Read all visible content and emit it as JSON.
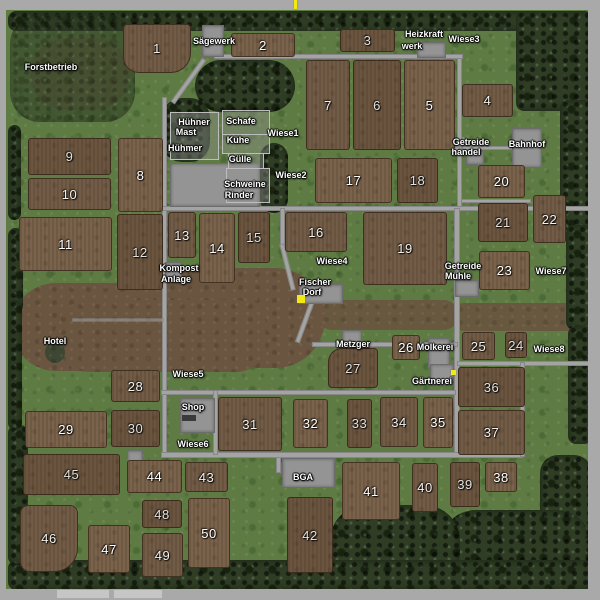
{
  "map": {
    "colors": {
      "grass": "#5e7b44",
      "field": "#6d5741",
      "forest": "#2e3d24",
      "dirt": "#6a5540",
      "road": "#a4a4a4",
      "building": "#949494",
      "frame": "#a9a9a9",
      "marker_yellow": "#f2ea12",
      "label_text": "#ffffff"
    },
    "fields": [
      {
        "n": "1",
        "x": 123,
        "y": 24,
        "w": 68,
        "h": 49,
        "br": "4px 4px 20px 16px"
      },
      {
        "n": "2",
        "x": 231,
        "y": 33,
        "w": 64,
        "h": 24
      },
      {
        "n": "3",
        "x": 340,
        "y": 29,
        "w": 55,
        "h": 23
      },
      {
        "n": "4",
        "x": 462,
        "y": 84,
        "w": 51,
        "h": 33
      },
      {
        "n": "5",
        "x": 404,
        "y": 60,
        "w": 51,
        "h": 90
      },
      {
        "n": "6",
        "x": 353,
        "y": 60,
        "w": 48,
        "h": 90
      },
      {
        "n": "7",
        "x": 306,
        "y": 60,
        "w": 44,
        "h": 90
      },
      {
        "n": "8",
        "x": 118,
        "y": 138,
        "w": 45,
        "h": 74
      },
      {
        "n": "9",
        "x": 28,
        "y": 138,
        "w": 83,
        "h": 37
      },
      {
        "n": "10",
        "x": 28,
        "y": 178,
        "w": 83,
        "h": 32
      },
      {
        "n": "11",
        "x": 19,
        "y": 217,
        "w": 93,
        "h": 54
      },
      {
        "n": "12",
        "x": 117,
        "y": 214,
        "w": 46,
        "h": 76
      },
      {
        "n": "13",
        "x": 168,
        "y": 212,
        "w": 28,
        "h": 46
      },
      {
        "n": "14",
        "x": 199,
        "y": 213,
        "w": 36,
        "h": 70
      },
      {
        "n": "15",
        "x": 238,
        "y": 212,
        "w": 32,
        "h": 51
      },
      {
        "n": "16",
        "x": 285,
        "y": 212,
        "w": 62,
        "h": 40
      },
      {
        "n": "17",
        "x": 315,
        "y": 158,
        "w": 77,
        "h": 45
      },
      {
        "n": "18",
        "x": 397,
        "y": 158,
        "w": 41,
        "h": 45
      },
      {
        "n": "19",
        "x": 363,
        "y": 212,
        "w": 84,
        "h": 73
      },
      {
        "n": "20",
        "x": 478,
        "y": 165,
        "w": 47,
        "h": 33
      },
      {
        "n": "21",
        "x": 478,
        "y": 203,
        "w": 50,
        "h": 39
      },
      {
        "n": "22",
        "x": 533,
        "y": 195,
        "w": 33,
        "h": 48
      },
      {
        "n": "23",
        "x": 479,
        "y": 251,
        "w": 51,
        "h": 39
      },
      {
        "n": "24",
        "x": 505,
        "y": 332,
        "w": 22,
        "h": 26
      },
      {
        "n": "25",
        "x": 462,
        "y": 332,
        "w": 33,
        "h": 28
      },
      {
        "n": "26",
        "x": 392,
        "y": 335,
        "w": 28,
        "h": 25
      },
      {
        "n": "27",
        "x": 328,
        "y": 348,
        "w": 50,
        "h": 40,
        "br": "14px 4px 4px 4px"
      },
      {
        "n": "28",
        "x": 111,
        "y": 370,
        "w": 49,
        "h": 32
      },
      {
        "n": "29",
        "x": 25,
        "y": 411,
        "w": 82,
        "h": 37
      },
      {
        "n": "30",
        "x": 111,
        "y": 410,
        "w": 49,
        "h": 37
      },
      {
        "n": "31",
        "x": 218,
        "y": 397,
        "w": 64,
        "h": 54
      },
      {
        "n": "32",
        "x": 293,
        "y": 399,
        "w": 35,
        "h": 49
      },
      {
        "n": "33",
        "x": 347,
        "y": 399,
        "w": 25,
        "h": 49
      },
      {
        "n": "34",
        "x": 380,
        "y": 397,
        "w": 38,
        "h": 50
      },
      {
        "n": "35",
        "x": 423,
        "y": 397,
        "w": 30,
        "h": 51
      },
      {
        "n": "36",
        "x": 458,
        "y": 367,
        "w": 67,
        "h": 40
      },
      {
        "n": "37",
        "x": 458,
        "y": 410,
        "w": 67,
        "h": 45
      },
      {
        "n": "38",
        "x": 485,
        "y": 462,
        "w": 32,
        "h": 30
      },
      {
        "n": "39",
        "x": 450,
        "y": 462,
        "w": 30,
        "h": 45
      },
      {
        "n": "40",
        "x": 412,
        "y": 463,
        "w": 26,
        "h": 49
      },
      {
        "n": "41",
        "x": 342,
        "y": 462,
        "w": 58,
        "h": 58
      },
      {
        "n": "42",
        "x": 287,
        "y": 497,
        "w": 46,
        "h": 76
      },
      {
        "n": "43",
        "x": 185,
        "y": 462,
        "w": 43,
        "h": 30
      },
      {
        "n": "44",
        "x": 127,
        "y": 460,
        "w": 55,
        "h": 33
      },
      {
        "n": "45",
        "x": 23,
        "y": 454,
        "w": 97,
        "h": 41
      },
      {
        "n": "46",
        "x": 20,
        "y": 505,
        "w": 58,
        "h": 67,
        "br": "8px 8px 24px 10px"
      },
      {
        "n": "47",
        "x": 88,
        "y": 525,
        "w": 42,
        "h": 48
      },
      {
        "n": "48",
        "x": 142,
        "y": 500,
        "w": 40,
        "h": 28
      },
      {
        "n": "49",
        "x": 142,
        "y": 533,
        "w": 41,
        "h": 44
      },
      {
        "n": "50",
        "x": 188,
        "y": 498,
        "w": 42,
        "h": 70
      }
    ],
    "place_labels": [
      {
        "t": "Forstbetrieb",
        "x": 51,
        "y": 67
      },
      {
        "t": "Sägewerk",
        "x": 214,
        "y": 41
      },
      {
        "t": "Heizkraft",
        "x": 424,
        "y": 34
      },
      {
        "t": "werk",
        "x": 412,
        "y": 46
      },
      {
        "t": "Wiese3",
        "x": 464,
        "y": 39
      },
      {
        "t": "Hühner",
        "x": 194,
        "y": 122
      },
      {
        "t": "Mast",
        "x": 186,
        "y": 132
      },
      {
        "t": "Hühmer",
        "x": 185,
        "y": 148
      },
      {
        "t": "Schafe",
        "x": 241,
        "y": 121
      },
      {
        "t": "Kühe",
        "x": 238,
        "y": 140
      },
      {
        "t": "Gülle",
        "x": 240,
        "y": 159
      },
      {
        "t": "Schweine",
        "x": 245,
        "y": 184
      },
      {
        "t": "Rinder",
        "x": 239,
        "y": 195
      },
      {
        "t": "Wiese1",
        "x": 283,
        "y": 133
      },
      {
        "t": "Wiese2",
        "x": 291,
        "y": 175
      },
      {
        "t": "Getreide",
        "x": 471,
        "y": 142
      },
      {
        "t": "handel",
        "x": 466,
        "y": 152
      },
      {
        "t": "Bahnhof",
        "x": 527,
        "y": 144
      },
      {
        "t": "Getreide",
        "x": 463,
        "y": 266
      },
      {
        "t": "Mühle",
        "x": 458,
        "y": 276
      },
      {
        "t": "Wiese7",
        "x": 551,
        "y": 271
      },
      {
        "t": "Kompost",
        "x": 179,
        "y": 268
      },
      {
        "t": "Anlage",
        "x": 176,
        "y": 279
      },
      {
        "t": "Wiese4",
        "x": 332,
        "y": 261
      },
      {
        "t": "Fischer",
        "x": 315,
        "y": 282
      },
      {
        "t": "Dorf",
        "x": 312,
        "y": 292
      },
      {
        "t": "Hotel",
        "x": 55,
        "y": 341
      },
      {
        "t": "Wiese5",
        "x": 188,
        "y": 374
      },
      {
        "t": "Metzger",
        "x": 353,
        "y": 344
      },
      {
        "t": "Molkerei",
        "x": 435,
        "y": 347
      },
      {
        "t": "Gärtnerei",
        "x": 432,
        "y": 381
      },
      {
        "t": "Wiese8",
        "x": 549,
        "y": 349
      },
      {
        "t": "Shop",
        "x": 193,
        "y": 407
      },
      {
        "t": "Wiese6",
        "x": 193,
        "y": 444
      },
      {
        "t": "BGA",
        "x": 303,
        "y": 477
      }
    ],
    "roads": [
      {
        "x": 214,
        "y": 54,
        "w": 249,
        "h": 5
      },
      {
        "x": 186,
        "y": 54,
        "w": 5,
        "h": 54,
        "rot": 36
      },
      {
        "x": 162,
        "y": 97,
        "w": 5,
        "h": 360
      },
      {
        "x": 457,
        "y": 58,
        "w": 5,
        "h": 150
      },
      {
        "x": 161,
        "y": 206,
        "w": 442,
        "h": 5
      },
      {
        "x": 454,
        "y": 208,
        "w": 6,
        "h": 250
      },
      {
        "x": 457,
        "y": 361,
        "w": 146,
        "h": 5
      },
      {
        "x": 312,
        "y": 342,
        "w": 146,
        "h": 5
      },
      {
        "x": 303,
        "y": 296,
        "w": 5,
        "h": 48,
        "rot": 20
      },
      {
        "x": 280,
        "y": 208,
        "w": 5,
        "h": 38
      },
      {
        "x": 285,
        "y": 243,
        "w": 5,
        "h": 48,
        "rot": -14
      },
      {
        "x": 161,
        "y": 452,
        "w": 362,
        "h": 6
      },
      {
        "x": 161,
        "y": 390,
        "w": 295,
        "h": 5
      },
      {
        "x": 213,
        "y": 390,
        "w": 5,
        "h": 65
      },
      {
        "x": 520,
        "y": 362,
        "w": 5,
        "h": 95
      },
      {
        "x": 276,
        "y": 457,
        "w": 5,
        "h": 16
      },
      {
        "x": 462,
        "y": 146,
        "w": 52,
        "h": 4
      },
      {
        "x": 456,
        "y": 136,
        "w": 5,
        "h": 20,
        "rot": 40
      },
      {
        "x": 420,
        "y": 47,
        "w": 4,
        "h": 10
      },
      {
        "x": 461,
        "y": 199,
        "w": 70,
        "h": 4
      },
      {
        "x": 72,
        "y": 318,
        "w": 92,
        "h": 4,
        "o": 0.55
      }
    ],
    "forest": [
      {
        "x": 8,
        "y": 11,
        "w": 584,
        "h": 20
      },
      {
        "x": 516,
        "y": 11,
        "w": 76,
        "h": 100
      },
      {
        "x": 560,
        "y": 100,
        "w": 32,
        "h": 130
      },
      {
        "x": 566,
        "y": 225,
        "w": 26,
        "h": 105
      },
      {
        "x": 568,
        "y": 326,
        "w": 24,
        "h": 118
      },
      {
        "x": 540,
        "y": 455,
        "w": 52,
        "h": 135,
        "r": 18
      },
      {
        "x": 440,
        "y": 510,
        "w": 152,
        "h": 80,
        "r": 36
      },
      {
        "x": 330,
        "y": 505,
        "w": 130,
        "h": 83,
        "r": 36
      },
      {
        "x": 8,
        "y": 560,
        "w": 584,
        "h": 30
      },
      {
        "x": 8,
        "y": 425,
        "w": 20,
        "h": 140
      },
      {
        "x": 8,
        "y": 125,
        "w": 13,
        "h": 95
      },
      {
        "x": 8,
        "y": 228,
        "w": 15,
        "h": 85
      },
      {
        "x": 8,
        "y": 300,
        "w": 14,
        "h": 130
      },
      {
        "x": 195,
        "y": 60,
        "w": 100,
        "h": 52,
        "r": 26
      },
      {
        "x": 162,
        "y": 98,
        "w": 48,
        "h": 64,
        "r": 20
      },
      {
        "x": 260,
        "y": 143,
        "w": 28,
        "h": 70,
        "r": 14
      },
      {
        "x": 10,
        "y": 14,
        "w": 125,
        "h": 108,
        "r": 30,
        "o": 0.55
      }
    ],
    "dirt": [
      {
        "x": 12,
        "y": 283,
        "w": 175,
        "h": 88,
        "r": 45
      },
      {
        "x": 130,
        "y": 268,
        "w": 195,
        "h": 100,
        "r": 50
      },
      {
        "x": 55,
        "y": 300,
        "w": 215,
        "h": 72,
        "r": 35
      },
      {
        "x": 318,
        "y": 300,
        "w": 140,
        "h": 30,
        "r": 14,
        "o": 0.9
      },
      {
        "x": 452,
        "y": 303,
        "w": 151,
        "h": 28,
        "r": 12,
        "o": 0.9
      },
      {
        "x": 30,
        "y": 38,
        "w": 100,
        "h": 72,
        "r": 40,
        "o": 0.45
      },
      {
        "x": 45,
        "y": 342,
        "w": 20,
        "h": 21,
        "r": "50%",
        "c": "#3d4734"
      }
    ],
    "buildings": [
      {
        "name": "sawmill",
        "x": 202,
        "y": 25,
        "w": 20,
        "h": 30,
        "type": "bld"
      },
      {
        "name": "heating-plant",
        "x": 417,
        "y": 42,
        "w": 27,
        "h": 14,
        "type": "bld"
      },
      {
        "name": "farm-yard",
        "x": 170,
        "y": 163,
        "w": 88,
        "h": 42,
        "type": "bld"
      },
      {
        "name": "chicken-pen",
        "x": 170,
        "y": 112,
        "w": 47,
        "h": 46,
        "type": "pen"
      },
      {
        "name": "sheep-pen",
        "x": 222,
        "y": 110,
        "w": 46,
        "h": 23,
        "type": "pen"
      },
      {
        "name": "cow-pen",
        "x": 222,
        "y": 134,
        "w": 46,
        "h": 18,
        "type": "pen"
      },
      {
        "name": "slurry-pen",
        "x": 228,
        "y": 153,
        "w": 34,
        "h": 14,
        "type": "pen"
      },
      {
        "name": "pig-cattle-pen",
        "x": 226,
        "y": 168,
        "w": 42,
        "h": 33,
        "type": "pen"
      },
      {
        "name": "grain-trader",
        "x": 466,
        "y": 150,
        "w": 16,
        "h": 13,
        "type": "bld"
      },
      {
        "name": "train-station",
        "x": 512,
        "y": 128,
        "w": 28,
        "h": 38,
        "type": "bld"
      },
      {
        "name": "grain-mill",
        "x": 455,
        "y": 280,
        "w": 22,
        "h": 15,
        "type": "bld"
      },
      {
        "name": "compost-plant",
        "x": 165,
        "y": 262,
        "w": 15,
        "h": 16,
        "type": "bld"
      },
      {
        "name": "fisher-village",
        "x": 299,
        "y": 284,
        "w": 42,
        "h": 18,
        "type": "bld"
      },
      {
        "name": "butcher",
        "x": 342,
        "y": 330,
        "w": 18,
        "h": 12,
        "type": "bld"
      },
      {
        "name": "dairy",
        "x": 428,
        "y": 338,
        "w": 20,
        "h": 28,
        "type": "bld"
      },
      {
        "name": "garden-center",
        "x": 430,
        "y": 364,
        "w": 22,
        "h": 19,
        "type": "bld"
      },
      {
        "name": "shop-building",
        "x": 180,
        "y": 398,
        "w": 33,
        "h": 33,
        "type": "bld"
      },
      {
        "name": "shop-vehicle",
        "x": 182,
        "y": 415,
        "w": 14,
        "h": 6,
        "type": "dark"
      },
      {
        "name": "bga-plant",
        "x": 282,
        "y": 458,
        "w": 51,
        "h": 28,
        "type": "bld"
      },
      {
        "name": "field-shed",
        "x": 127,
        "y": 450,
        "w": 14,
        "h": 11,
        "type": "bld"
      }
    ],
    "markers": [
      {
        "name": "player-position-marker",
        "x": 297,
        "y": 295,
        "w": 8,
        "h": 8
      },
      {
        "name": "north-tick",
        "x": 294,
        "y": 0,
        "w": 3,
        "h": 9
      },
      {
        "name": "garden-center-marker",
        "x": 451,
        "y": 370,
        "w": 5,
        "h": 5
      }
    ]
  }
}
